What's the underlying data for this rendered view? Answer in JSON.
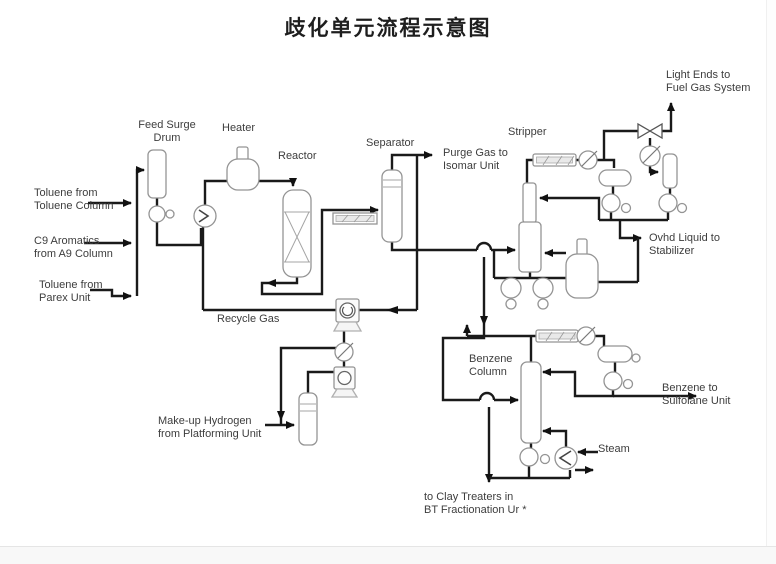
{
  "title": "歧化单元流程示意图",
  "colors": {
    "pipe": "#1a1a1a",
    "equipment_outline": "#949494",
    "text": "#3d3d3d",
    "background": "#ffffff"
  },
  "labels": {
    "feed_surge_drum": "Feed Surge\nDrum",
    "heater": "Heater",
    "reactor": "Reactor",
    "separator": "Separator",
    "purge_gas": "Purge Gas to\nIsomar Unit",
    "stripper": "Stripper",
    "light_ends": "Light Ends to\nFuel Gas System",
    "ovhd_liquid": "Ovhd Liquid to\nStabilizer",
    "toluene_toluene": "Toluene from\nToluene Column",
    "c9_aromatics": "C9 Aromatics\nfrom A9 Column",
    "toluene_parex": "Toluene from\nParex Unit",
    "recycle_gas": "Recycle Gas",
    "makeup_h2": "Make-up Hydrogen\nfrom Platforming Unit",
    "benzene_column": "Benzene\nColumn",
    "benzene_sulfolane": "Benzene to\nSulfolane Unit",
    "steam": "Steam",
    "clay_treaters": "to Clay Treaters in\nBT Fractionation Ur *"
  }
}
